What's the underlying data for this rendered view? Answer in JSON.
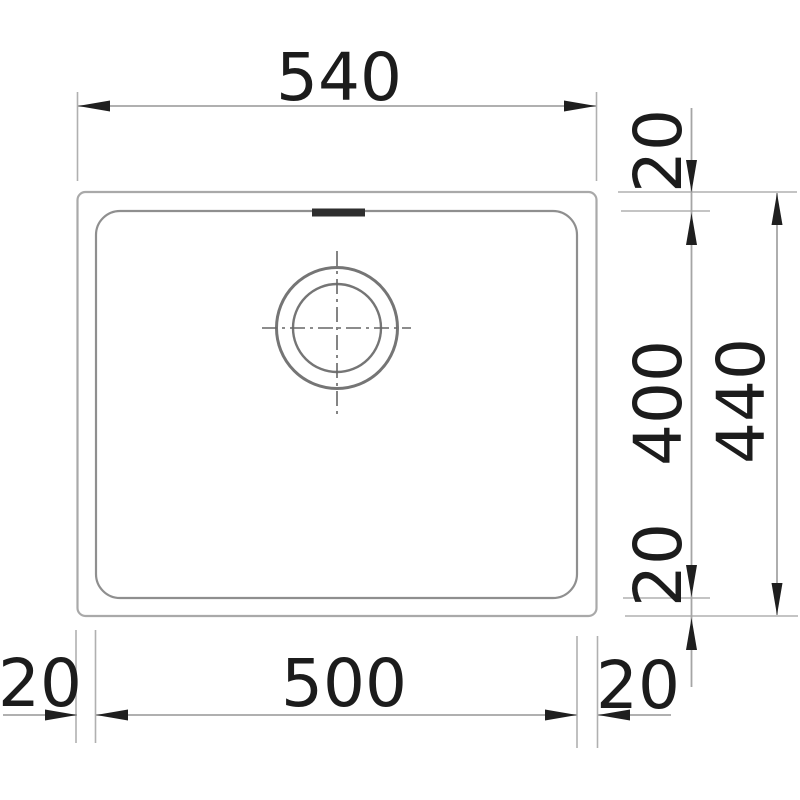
{
  "drawing": {
    "subject": "sink-top-view-dimension-drawing",
    "labels": {
      "overall_width": "540",
      "rim_top": "20",
      "bowl_depth": "400",
      "overall_depth": "440",
      "rim_bottom": "20",
      "rim_left": "20",
      "bowl_width": "500",
      "rim_right": "20"
    },
    "colors": {
      "background": "#ffffff",
      "outer_outline": "#a9a9a9",
      "inner_outline": "#8f8f8f",
      "drain_circles": "#757575",
      "dimension_lines": "#a5a5a5",
      "extension_lines": "#b0b0b0",
      "centerlines": "#666666",
      "arrows_and_text": "#1c1c1c",
      "overflow_mark": "#2e2e2e"
    }
  }
}
